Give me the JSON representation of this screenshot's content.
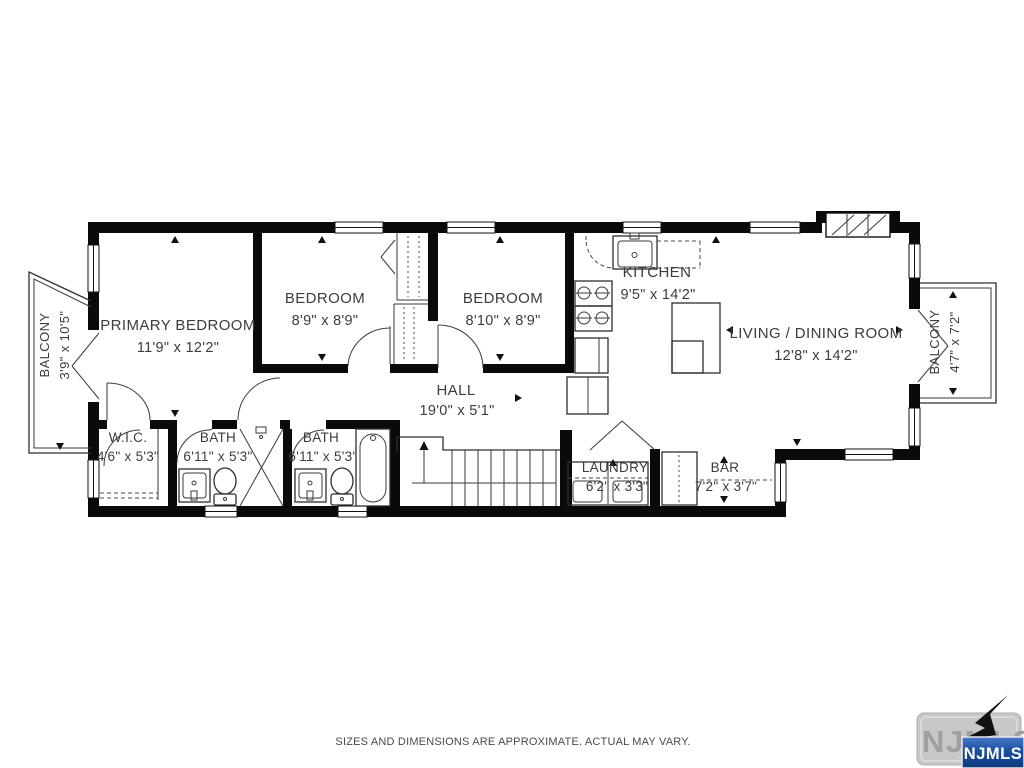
{
  "rooms": {
    "balcony_left": {
      "label": "BALCONY",
      "dims": "3'9\" x 10'5\""
    },
    "primary_bedroom": {
      "label": "PRIMARY BEDROOM",
      "dims": "11'9\" x 12'2\""
    },
    "bedroom_1": {
      "label": "BEDROOM",
      "dims": "8'9\" x 8'9\""
    },
    "bedroom_2": {
      "label": "BEDROOM",
      "dims": "8'10\" x 8'9\""
    },
    "kitchen": {
      "label": "KITCHEN",
      "dims": "9'5\" x 14'2\""
    },
    "living_dining": {
      "label": "LIVING / DINING ROOM",
      "dims": "12'8\" x 14'2\""
    },
    "balcony_right": {
      "label": "BALCONY",
      "dims": "4'7\" x 7'2\""
    },
    "hall": {
      "label": "HALL",
      "dims": "19'0\" x 5'1\""
    },
    "wic": {
      "label": "W.I.C.",
      "dims": "4'6\" x 5'3\""
    },
    "bath_1": {
      "label": "BATH",
      "dims": "6'11\" x 5'3\""
    },
    "bath_2": {
      "label": "BATH",
      "dims": "6'11\" x 5'3\""
    },
    "laundry": {
      "label": "LAUNDRY",
      "dims": "6'2\" x 3'3\""
    },
    "bar": {
      "label": "BAR",
      "dims": "7'2\" x 3'7\""
    }
  },
  "footer": {
    "disclaimer": "SIZES AND DIMENSIONS ARE APPROXIMATE. ACTUAL MAY VARY."
  },
  "logo": {
    "watermark": "NJMLS",
    "badge": "NJMLS"
  },
  "colors": {
    "wall": "#0a0a0a",
    "background": "#ffffff",
    "label_text": "#3c3c3c",
    "logo_blue_dark": "#0c3a7e",
    "logo_blue_light": "#4678c8",
    "logo_gray": "#c7c7c7"
  }
}
